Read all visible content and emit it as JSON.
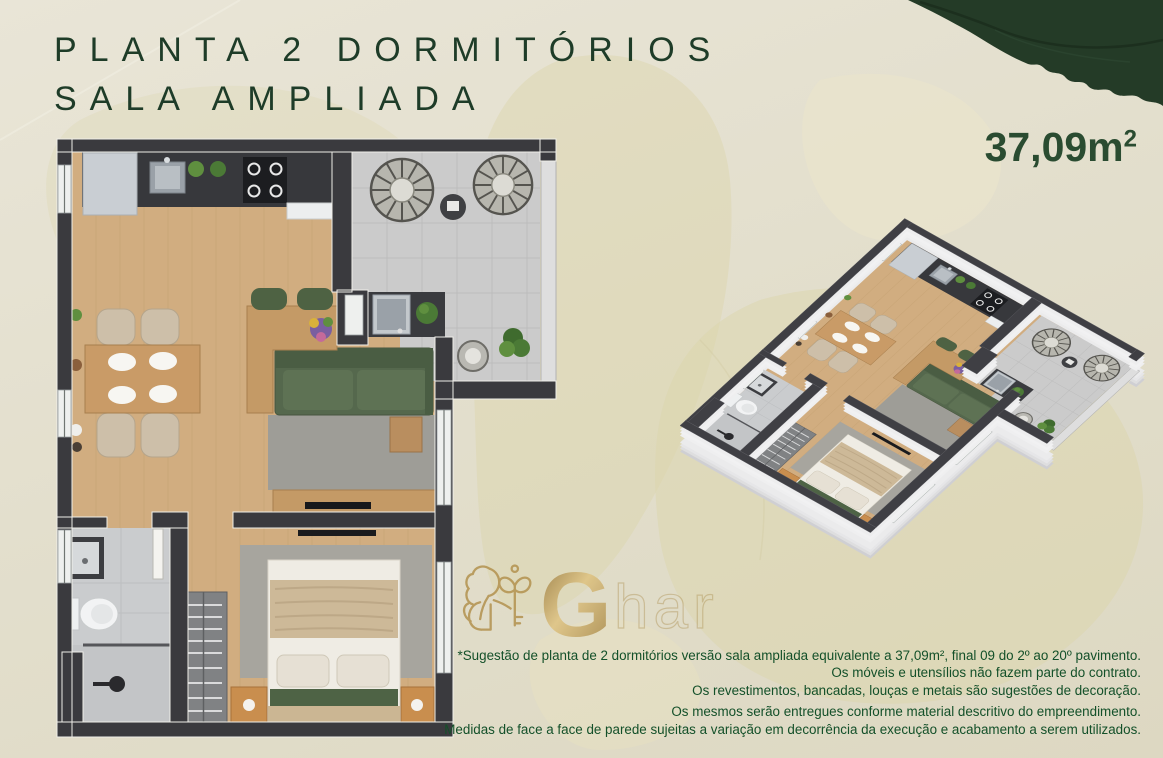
{
  "header": {
    "title_line1": "PLANTA 2 DORMITÓRIOS",
    "title_line2": "SALA AMPLIADA",
    "area_value": "37,09m",
    "area_sup": "2"
  },
  "watermark": {
    "brand_initial": "G",
    "brand_rest": "har",
    "logo_icon": "lion-with-key"
  },
  "disclaimer": {
    "lines": [
      "*Sugestão de planta de 2 dormitórios versão sala ampliada equivalente a 37,09m², final 09 do 2º ao 20º pavimento.",
      "Os móveis e utensílios não fazem parte do contrato.",
      "Os revestimentos, bancadas, louças e metais são sugestões de decoração.",
      "Os mesmos serão entregues conforme material descritivo do empreendimento.",
      "Medidas de face a face de parede sujeitas a variação em decorrência da execução e acabamento a serem utilizados."
    ]
  },
  "floor_plans": {
    "plan_2d": "2d-top-view-floor-plan",
    "plan_3d": "3d-isometric-floor-plan"
  },
  "colors": {
    "background": "#e4dfce",
    "leaf_shapes": "#dcd5ab",
    "corner_leaf": "#243b27",
    "title_green": "#1e3c28",
    "disclaimer_green": "#135029",
    "gold": "#b3924e",
    "wall_dark": "#3a3a3e",
    "wood_floor": "#d1ad80",
    "tile_gray": "#cbcbcb",
    "sofa_green": "#55684d"
  }
}
